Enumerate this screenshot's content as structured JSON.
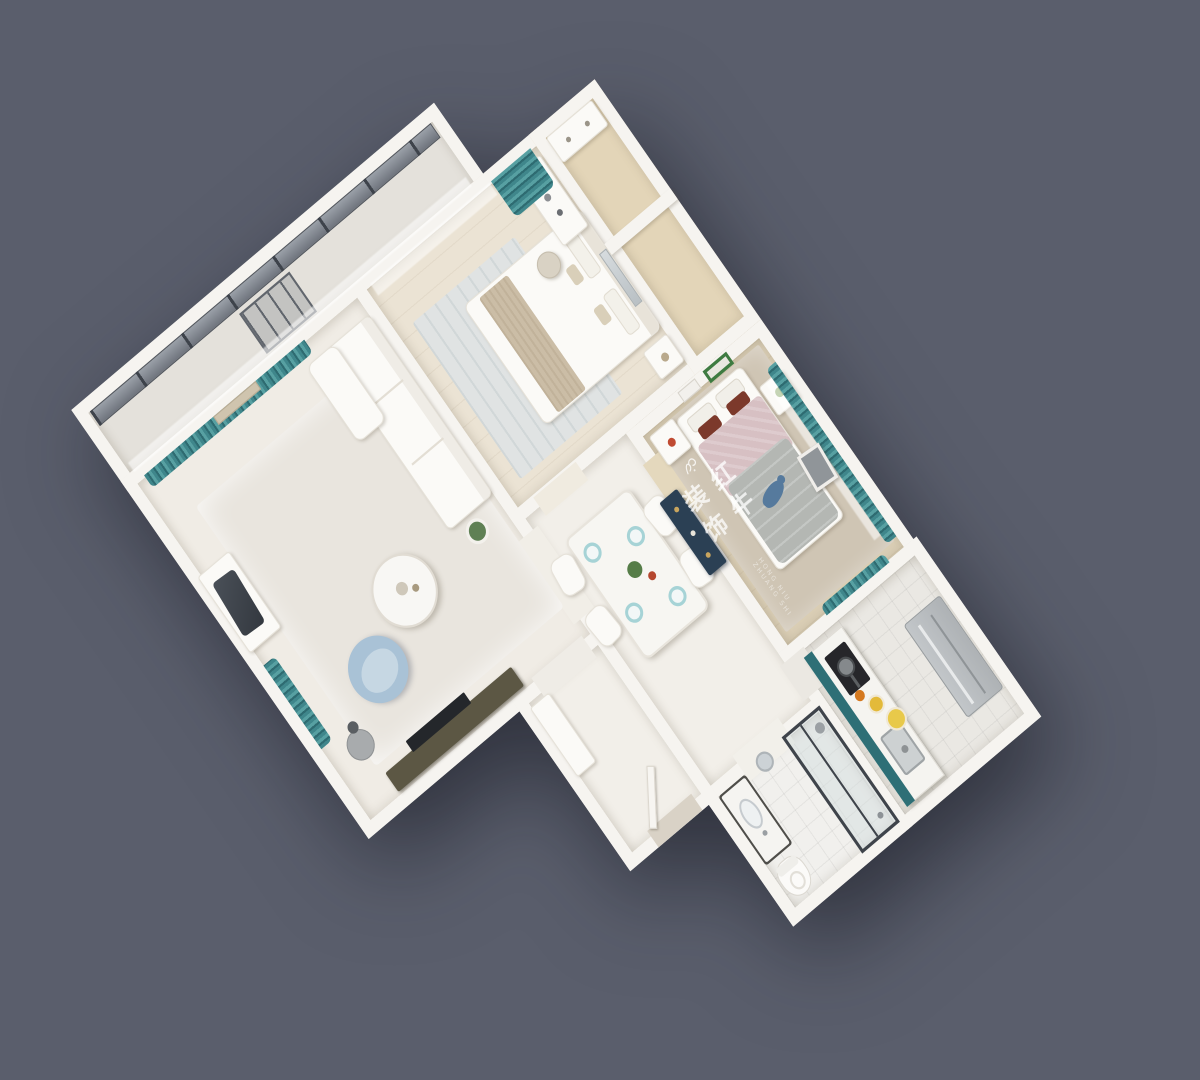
{
  "scene": {
    "type": "3d-floor-plan-render",
    "view": "isometric-top-down, plan rotated ~40 degrees on dark slate backdrop",
    "watermark": {
      "logo": "red-bull-brand-logo",
      "text": "红牛装饰",
      "subtext": "HONG NIU ZHUANG SHI"
    },
    "rooms": [
      {
        "id": "balcony",
        "features": [
          "glass-curtain-wall",
          "window-lattice",
          "sheer-curtain",
          "tile-floor"
        ]
      },
      {
        "id": "master-bedroom",
        "features": [
          "double-bed-white",
          "beige-throw",
          "dressing-desk",
          "stool",
          "nightstand",
          "mirror-panel",
          "teal-curtain",
          "sheer-curtain",
          "blue-gray-rug",
          "wood-floor"
        ]
      },
      {
        "id": "wardrobe-nook",
        "features": [
          "cabinet",
          "tan-floor"
        ]
      },
      {
        "id": "living-room",
        "features": [
          "white-sofa",
          "chaise",
          "round-coffee-table",
          "blue-armchair",
          "side-table",
          "floor-lamp",
          "desk-with-dark-chair",
          "media-console",
          "tv",
          "teal-curtains",
          "wall-art",
          "area-rug"
        ]
      },
      {
        "id": "dining-hall",
        "features": [
          "marble-dining-table",
          "four-white-chairs",
          "teal-place-settings",
          "plant-centerpiece",
          "navy-console"
        ]
      },
      {
        "id": "bedroom-2",
        "features": [
          "double-bed-pink-gray",
          "dark-red-pillows",
          "whale-plush",
          "two-nightstands",
          "green-frame-art",
          "white-frame-art",
          "teal-curtains",
          "leaning-frame",
          "tan-carpet",
          "wood-floor"
        ]
      },
      {
        "id": "bathroom",
        "features": [
          "vanity-dark-base",
          "oval-sink",
          "round-mirror",
          "toilet",
          "glass-shower",
          "tile-floor"
        ]
      },
      {
        "id": "kitchen",
        "features": [
          "counter-teal-edge",
          "cooktop-with-pan",
          "sink",
          "fruit-plates",
          "refrigerator",
          "tile-floor"
        ]
      },
      {
        "id": "foyer",
        "features": [
          "shoe-cabinet",
          "entry-door-ajar",
          "threshold-mat"
        ]
      }
    ]
  },
  "palette": {
    "bg": "#5a5e6c",
    "wall": "#f6f4f0",
    "teal": "#3f868b",
    "navy": "#2b4054",
    "counterTeal": "#2e6f76",
    "blueChair": "#a9c2d6",
    "masterFloor": "#ebe3d4",
    "bedroom2Floor": "#dbcfb6",
    "carpetTan": "#cfc5b4",
    "pinkBed": "#d7c0c3",
    "grayQuilt": "#b4b7b3",
    "redPillow": "#7c392b",
    "whaleBlue": "#567a9d",
    "oliveConsole": "#5c5744",
    "fruitYellow": "#e3ba3a",
    "livingFloor": "#f0ece5",
    "hallFloor": "#f2efe9",
    "bathFloor": "#f1f0ed",
    "kitchenFloor": "#eae8e3",
    "closetFloor": "#e3d5b8",
    "balconyFloor": "#e4e1db",
    "glassDark": "#767b84",
    "steel": "#b7bbbe"
  }
}
